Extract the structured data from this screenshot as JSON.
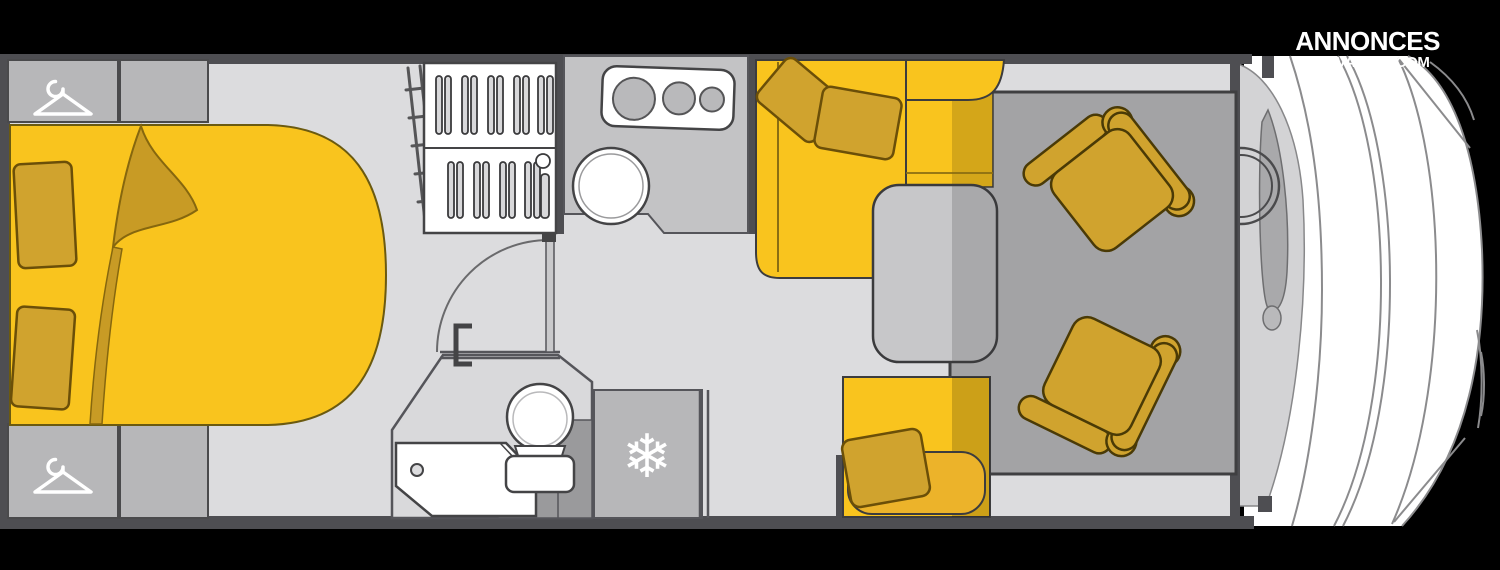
{
  "logo": {
    "line1": "ANNONCES",
    "line2": "CARAVANING.COM",
    "color": "#ffffff"
  },
  "floorplan": {
    "type": "motorhome-floor-plan",
    "colors": {
      "background": "#000000",
      "floor": "#dcdcde",
      "wall": "#4e4e52",
      "accent_yellow": "#f9c41e",
      "cushion_mustard": "#d0a32e",
      "duvet_fold": "#c89b25",
      "cabinet_gray": "#b7b7b9",
      "counter_gray": "#c3c3c5",
      "rug_gray": "#a3a3a5",
      "table_gray": "#c7c7c9",
      "white": "#ffffff"
    },
    "icons": {
      "rear_wardrobe": "hanger-icon",
      "front_wardrobe": "hanger-icon",
      "fridge": "snowflake-icon",
      "fridge_glyph": "❄"
    }
  }
}
